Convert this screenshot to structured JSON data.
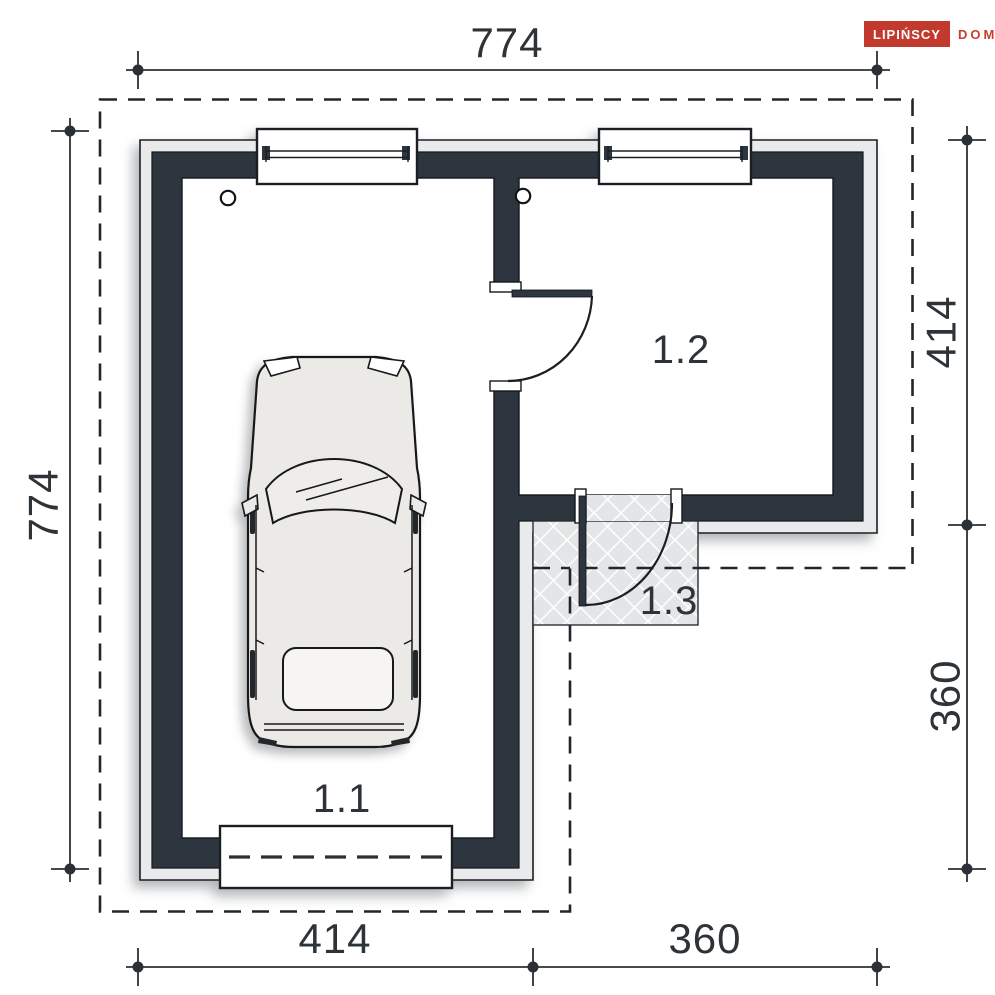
{
  "brand": {
    "primary": "LIPIŃSCY",
    "secondary": "DOMY",
    "box_color": "#c23a2d"
  },
  "dimensions": {
    "top": "774",
    "left": "774",
    "right_upper": "414",
    "right_lower": "360",
    "bottom_left": "414",
    "bottom_right": "360"
  },
  "rooms": {
    "garage": "1.1",
    "room": "1.2",
    "porch": "1.3"
  },
  "colors": {
    "wall_fill": "#2d363f",
    "finish_layer_fill": "#e9eaeb",
    "porch_fill": "#e4e5e7",
    "line": "#1b1f23",
    "car_body": "#eceae6",
    "dimension_text": "#2e3338",
    "background": "#ffffff"
  }
}
